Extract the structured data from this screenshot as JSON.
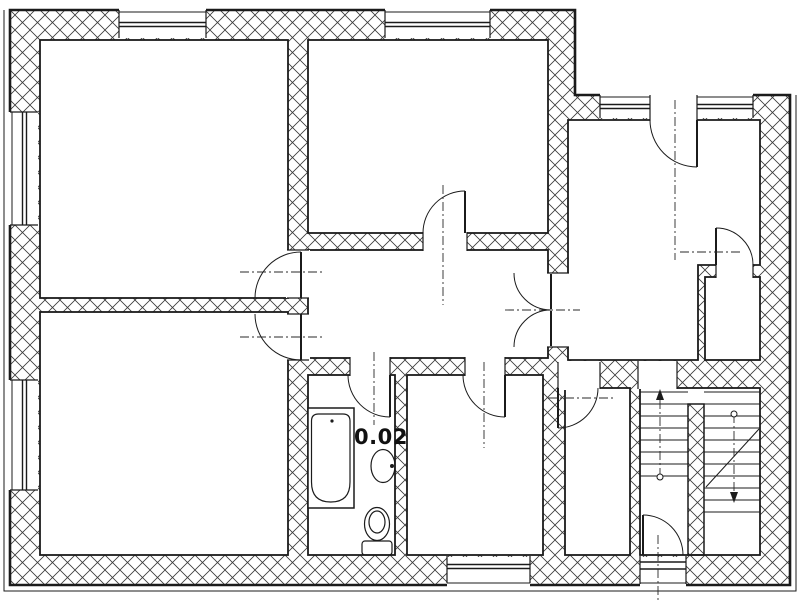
{
  "document": {
    "type": "architectural-floor-plan",
    "style": "black-and-white scanned line drawing with cross-hatched walls"
  },
  "colors": {
    "background": "#ffffff",
    "line": "#1b1b1b",
    "hatch": "#3a3a3a"
  },
  "rooms": {
    "bathroom": {
      "label": "0.02"
    }
  },
  "fixtures": [
    {
      "name": "bathtub"
    },
    {
      "name": "wash-basin"
    },
    {
      "name": "toilet"
    },
    {
      "name": "staircase-up-flight"
    },
    {
      "name": "staircase-down-flight"
    }
  ],
  "doors": [
    "top-left-room-door",
    "bottom-left-room-door",
    "top-middle-room-door",
    "bathroom-door",
    "bottom-middle-room-door",
    "hall-double-door",
    "balcony-door",
    "closet-door",
    "corridor-room-door",
    "entrance-door"
  ],
  "windows": [
    "top-wall-window-left",
    "top-wall-window-middle",
    "top-right-window-band",
    "left-wall-window-upper",
    "left-wall-window-lower",
    "bottom-wall-window"
  ]
}
